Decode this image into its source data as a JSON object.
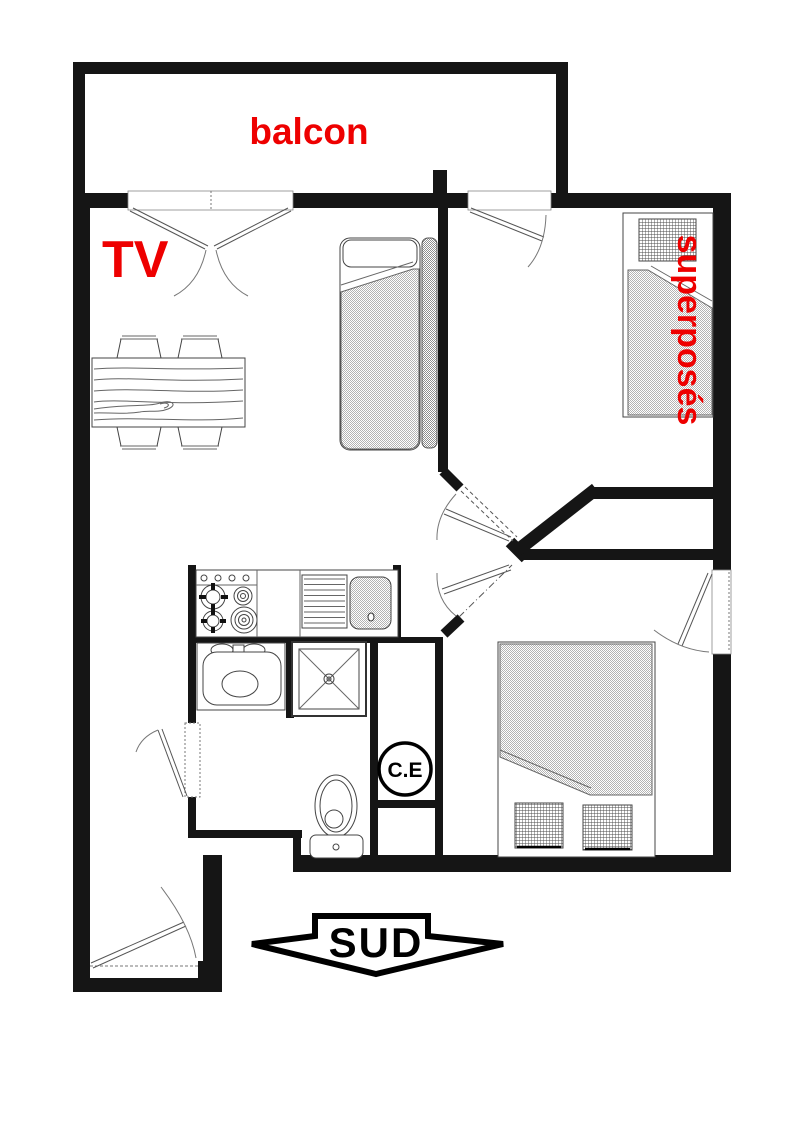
{
  "floor_plan": {
    "labels": {
      "balcony": "balcon",
      "tv": "TV",
      "bunk_beds": "superposés",
      "water_heater": "C.E",
      "south": "SUD"
    },
    "colors": {
      "label_red": "#ee0000",
      "wall": "#151515",
      "furniture_outline": "#444444",
      "background": "#ffffff"
    },
    "icons": {
      "south_arrow": "down-arrow-banner",
      "water_heater_symbol": "circled-text"
    }
  }
}
